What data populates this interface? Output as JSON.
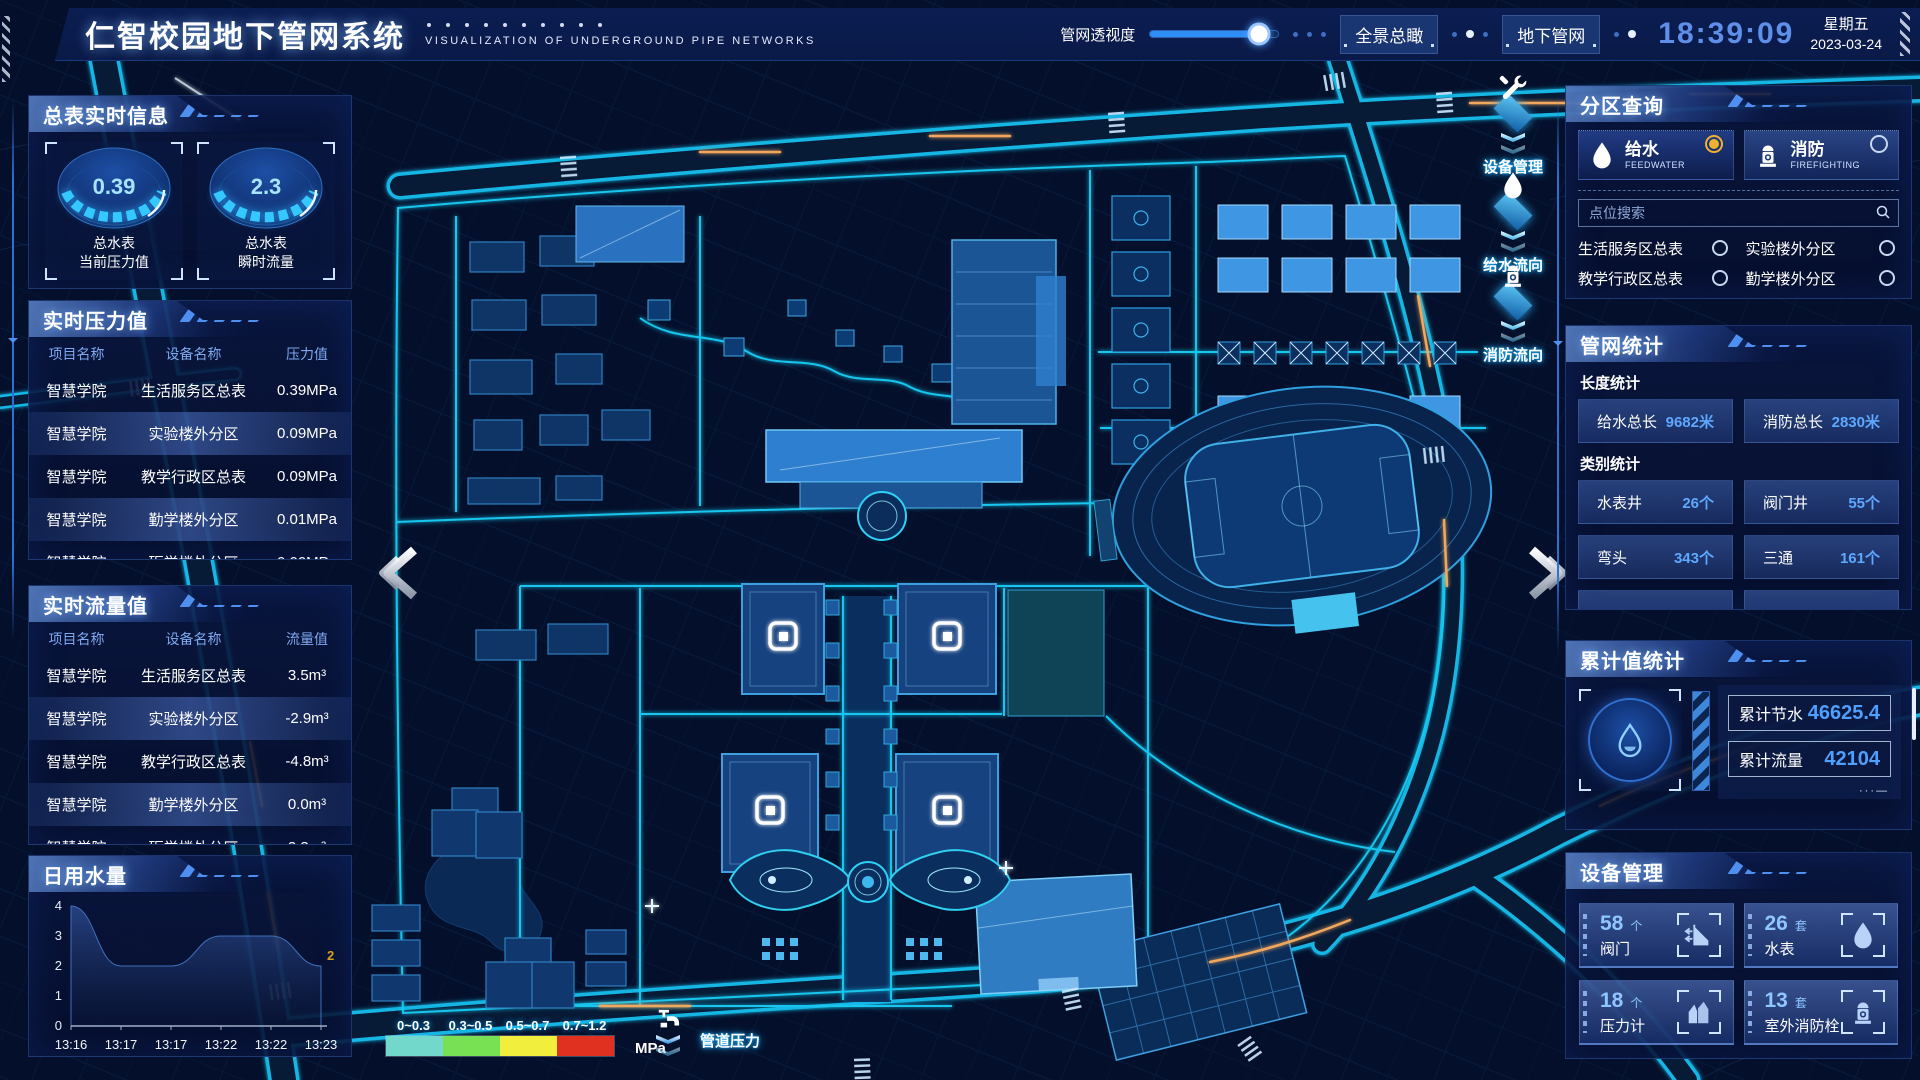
{
  "header": {
    "title": "仁智校园地下管网系统",
    "subtitle": "VISUALIZATION OF UNDERGROUND PIPE NETWORKS",
    "opacity_label": "管网透视度",
    "opacity_percent": 85,
    "buttons": [
      {
        "label": "全景总瞰"
      },
      {
        "label": "地下管网"
      }
    ],
    "clock": {
      "time": "18:39:09",
      "weekday": "星期五",
      "date": "2023-03-24"
    }
  },
  "meter_panel": {
    "title": "总表实时信息",
    "gauges": [
      {
        "value": "0.39",
        "label_line1": "总水表",
        "label_line2": "当前压力值"
      },
      {
        "value": "2.3",
        "label_line1": "总水表",
        "label_line2": "瞬时流量"
      }
    ]
  },
  "pressure_panel": {
    "title": "实时压力值",
    "columns": [
      "项目名称",
      "设备名称",
      "压力值"
    ],
    "rows": [
      [
        "智慧学院",
        "生活服务区总表",
        "0.39MPa"
      ],
      [
        "智慧学院",
        "实验楼外分区",
        "0.09MPa"
      ],
      [
        "智慧学院",
        "教学行政区总表",
        "0.09MPa"
      ],
      [
        "智慧学院",
        "勤学楼外分区",
        "0.01MPa"
      ],
      [
        "智慧学院",
        "砺学楼外分区",
        "0.00MPa"
      ]
    ]
  },
  "flow_panel": {
    "title": "实时流量值",
    "columns": [
      "项目名称",
      "设备名称",
      "流量值"
    ],
    "rows": [
      [
        "智慧学院",
        "生活服务区总表",
        "3.5m³"
      ],
      [
        "智慧学院",
        "实验楼外分区",
        "-2.9m³"
      ],
      [
        "智慧学院",
        "教学行政区总表",
        "-4.8m³"
      ],
      [
        "智慧学院",
        "勤学楼外分区",
        "0.0m³"
      ],
      [
        "智慧学院",
        "砺学楼外分区",
        "2.3m³"
      ]
    ]
  },
  "daily_water_panel": {
    "title": "日用水量",
    "chart_data": {
      "type": "area",
      "x": [
        "13:16",
        "13:17",
        "13:17",
        "13:22",
        "13:22",
        "13:23"
      ],
      "values": [
        4,
        2,
        2,
        3,
        3,
        2
      ],
      "ylim": [
        0,
        4
      ],
      "yticks": [
        0,
        1,
        2,
        3,
        4
      ],
      "end_label": "2",
      "end_label_color": "#d8a020"
    }
  },
  "zone_panel": {
    "title": "分区查询",
    "tabs": [
      {
        "label": "给水",
        "sub": "FEEDWATER",
        "icon": "water-drop-icon",
        "selected": true
      },
      {
        "label": "消防",
        "sub": "FIREFIGHTING",
        "icon": "hydrant-icon",
        "selected": false
      }
    ],
    "search_placeholder": "点位搜索",
    "items": [
      "生活服务区总表",
      "实验楼外分区",
      "教学行政区总表",
      "勤学楼外分区",
      "砺学楼外分区",
      "宿舍区泵房"
    ]
  },
  "pipe_stats_panel": {
    "title": "管网统计",
    "groups": [
      {
        "label": "长度统计",
        "chips": [
          {
            "name": "给水总长",
            "value": "9682米"
          },
          {
            "name": "消防总长",
            "value": "2830米"
          }
        ]
      },
      {
        "label": "类别统计",
        "chips": [
          {
            "name": "水表井",
            "value": "26个"
          },
          {
            "name": "阀门井",
            "value": "55个"
          },
          {
            "name": "弯头",
            "value": "343个"
          },
          {
            "name": "三通",
            "value": "161个"
          }
        ]
      }
    ]
  },
  "cumulative_panel": {
    "title": "累计值统计",
    "rows": [
      {
        "name": "累计节水",
        "value": "46625.4"
      },
      {
        "name": "累计流量",
        "value": "42104"
      }
    ]
  },
  "device_panel": {
    "title": "设备管理",
    "cards": [
      {
        "count": "58",
        "unit": "个",
        "label": "阀门",
        "icon": "valve-icon"
      },
      {
        "count": "26",
        "unit": "套",
        "label": "水表",
        "icon": "water-drop-icon"
      },
      {
        "count": "18",
        "unit": "个",
        "label": "压力计",
        "icon": "pressure-gauge-icon"
      },
      {
        "count": "13",
        "unit": "套",
        "label": "室外消防栓",
        "icon": "hydrant-icon"
      }
    ]
  },
  "map_overlays": {
    "tool_items": [
      {
        "label": "设备管理",
        "icon": "wrench-icon"
      },
      {
        "label": "给水流向",
        "icon": "water-drop-icon"
      },
      {
        "label": "消防流向",
        "icon": "hydrant-icon"
      }
    ],
    "legend": {
      "ranges": [
        "0~0.3",
        "0.3~0.5",
        "0.5~0.7",
        "0.7~1.2"
      ],
      "colors": [
        "#72d8cc",
        "#77e153",
        "#f1ee3e",
        "#e03020"
      ],
      "unit": "MPa",
      "label": "管道压力"
    }
  },
  "colors": {
    "accent": "#2fa0ff",
    "value_blue": "#4f9fff",
    "cyan": "#1fd0f5",
    "selected_radio": "#f0b030"
  }
}
